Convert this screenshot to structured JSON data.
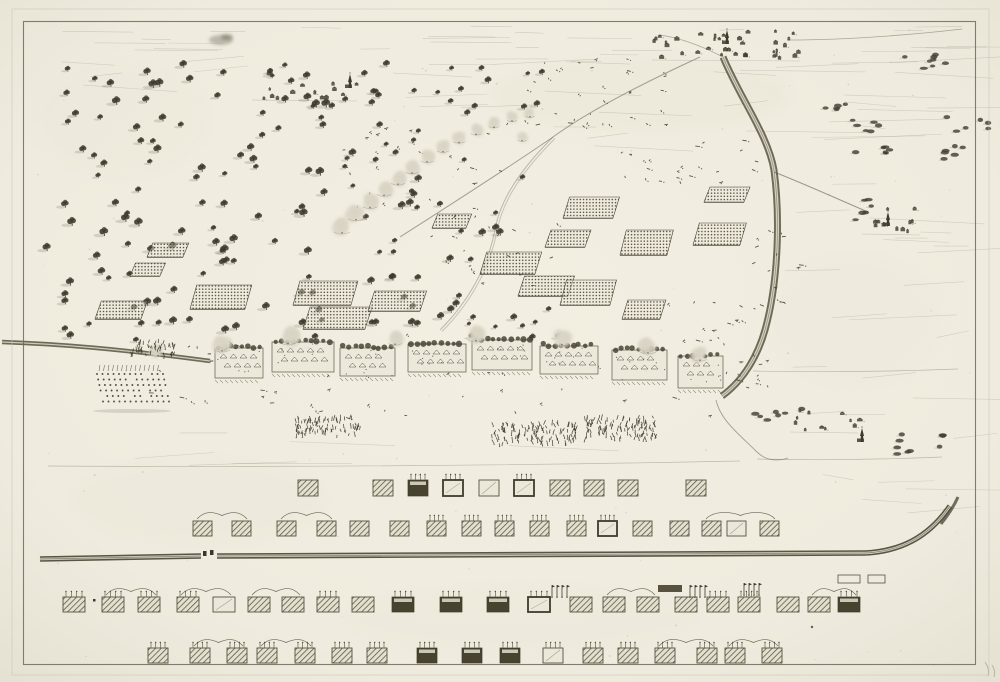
{
  "palette": {
    "paper": "#f0ecdf",
    "paper_edge": "#e6e2d3",
    "ink": "#3f3b2c",
    "ink_mid": "#57533f",
    "ink_light": "#8a8575",
    "smoke": "#d9d4c4",
    "block_light": "#ece8d9",
    "block_dark": "#47432f",
    "road_core": "#d8d4c4",
    "border": "#6d6958",
    "plate_mark": "#c9c4b4",
    "pencil": "#a09a8a"
  },
  "plate": {
    "border": [
      23,
      21,
      952,
      643
    ],
    "plate_mark": [
      12,
      9,
      977,
      666
    ]
  },
  "scene": {
    "speckles": 90,
    "stains": [
      [
        640,
        95,
        150,
        38,
        0.3
      ],
      [
        200,
        500,
        130,
        45,
        0.22
      ],
      [
        520,
        620,
        180,
        35,
        0.16
      ],
      [
        120,
        120,
        90,
        60,
        0.16
      ],
      [
        850,
        320,
        90,
        70,
        0.14
      ]
    ],
    "sky_band": [
      50,
      26,
      910,
      36,
      26
    ],
    "cloud": [
      221,
      40,
      12,
      5
    ],
    "field_line_regions": [
      [
        540,
        62,
        420,
        125,
        22
      ],
      [
        770,
        205,
        195,
        245,
        18
      ],
      [
        380,
        57,
        300,
        65,
        8
      ],
      [
        60,
        432,
        480,
        34,
        6
      ],
      [
        762,
        468,
        190,
        50,
        5
      ],
      [
        40,
        60,
        260,
        40,
        5
      ]
    ],
    "long_lines": [
      [
        48,
        466,
        740,
        461
      ],
      [
        757,
        459,
        942,
        457
      ],
      [
        753,
        371,
        958,
        369
      ]
    ],
    "tree_fields": [
      [
        45,
        58,
        285,
        285,
        105,
        1
      ],
      [
        335,
        150,
        190,
        115,
        26,
        0.9
      ],
      [
        430,
        66,
        130,
        50,
        12,
        0.8
      ],
      [
        250,
        60,
        170,
        45,
        10,
        0.8
      ],
      [
        340,
        270,
        120,
        60,
        14,
        0.9
      ],
      [
        460,
        300,
        120,
        40,
        10,
        0.8
      ],
      [
        300,
        95,
        120,
        55,
        10,
        0.85
      ]
    ],
    "bush_clusters": [
      [
        823,
        103,
        28,
        10,
        5
      ],
      [
        848,
        120,
        34,
        12,
        6
      ],
      [
        852,
        143,
        38,
        12,
        6
      ],
      [
        896,
        50,
        50,
        22,
        8
      ],
      [
        946,
        116,
        44,
        16,
        6
      ],
      [
        941,
        146,
        44,
        14,
        6
      ],
      [
        845,
        196,
        30,
        24,
        6
      ],
      [
        745,
        408,
        60,
        16,
        7
      ],
      [
        862,
        434,
        88,
        20,
        9
      ]
    ],
    "villages": [
      {
        "x": 652,
        "y": 30,
        "w": 148,
        "h": 28,
        "count": 36,
        "church": [
          727,
          44
        ]
      },
      {
        "x": 862,
        "y": 208,
        "w": 58,
        "h": 24,
        "count": 11,
        "church": [
          888,
          226
        ]
      },
      {
        "x": 790,
        "y": 410,
        "w": 68,
        "h": 20,
        "count": 11,
        "church": [
          862,
          442
        ]
      },
      {
        "x": 252,
        "y": 82,
        "w": 105,
        "h": 16,
        "count": 13,
        "church": [
          350,
          88
        ]
      }
    ],
    "roads": [
      {
        "d": "M723,57 C741,100 768,135 774,170 C780,215 779,280 765,330 C758,355 744,380 722,396",
        "w": 7,
        "o": 0.85,
        "core": true
      },
      {
        "d": "M700,57 C650,80 590,110 553,137 C505,170 450,205 400,237",
        "w": 1,
        "o": 0.5
      },
      {
        "d": "M774,172 C800,182 840,200 868,212",
        "w": 1,
        "o": 0.55
      },
      {
        "d": "M790,40 C850,40 920,34 962,29",
        "w": 0.8,
        "o": 0.45
      },
      {
        "d": "M553,137 C520,170 500,200 495,230 C488,265 470,300 440,330",
        "w": 1,
        "o": 0.35,
        "double": true
      },
      {
        "d": "M716,400 C720,420 740,435 757,452 C765,460 775,462 788,458",
        "w": 0.9,
        "o": 0.5
      },
      {
        "d": "M660,35 C680,38 700,45 723,57",
        "w": 0.8,
        "o": 0.45
      }
    ],
    "smoke_line": [
      [
        342,
        228
      ],
      [
        356,
        215
      ],
      [
        370,
        203
      ],
      [
        384,
        191
      ],
      [
        398,
        180
      ],
      [
        412,
        169
      ],
      [
        427,
        158
      ],
      [
        443,
        148
      ],
      [
        459,
        139
      ],
      [
        476,
        131
      ],
      [
        494,
        124
      ],
      [
        512,
        118
      ],
      [
        530,
        114
      ],
      [
        522,
        138
      ]
    ],
    "battalions": [
      [
        190,
        285,
        55,
        24
      ],
      [
        293,
        281,
        58,
        24
      ],
      [
        303,
        307,
        62,
        22
      ],
      [
        368,
        291,
        52,
        20
      ],
      [
        480,
        252,
        55,
        22
      ],
      [
        518,
        276,
        50,
        20
      ],
      [
        545,
        230,
        40,
        17
      ],
      [
        563,
        197,
        50,
        21
      ],
      [
        620,
        230,
        47,
        25
      ],
      [
        693,
        223,
        47,
        22
      ],
      [
        704,
        187,
        40,
        15
      ],
      [
        560,
        280,
        50,
        25
      ],
      [
        622,
        300,
        38,
        19
      ],
      [
        130,
        263,
        30,
        13
      ],
      [
        147,
        243,
        36,
        14
      ],
      [
        95,
        301,
        46,
        18
      ],
      [
        432,
        214,
        34,
        14
      ]
    ],
    "cavalry_fields": [
      [
        520,
        58,
        145,
        75,
        34
      ],
      [
        615,
        138,
        150,
        50,
        22
      ],
      [
        745,
        230,
        60,
        80,
        16
      ],
      [
        340,
        120,
        170,
        90,
        26
      ],
      [
        150,
        330,
        560,
        95,
        55
      ],
      [
        420,
        210,
        140,
        80,
        20
      ],
      [
        660,
        300,
        90,
        50,
        14
      ],
      [
        726,
        352,
        46,
        40,
        12
      ]
    ],
    "pike_block": [
      93,
      372,
      78,
      36
    ],
    "spike_clusters": [
      [
        294,
        418,
        66,
        20
      ],
      [
        492,
        424,
        84,
        22
      ],
      [
        582,
        418,
        74,
        24
      ],
      [
        128,
        342,
        48,
        16
      ]
    ],
    "wall": {
      "d": "M2,342 C60,344 120,349 210,361",
      "w": 4.5
    },
    "redoubts": [
      [
        215,
        344,
        48,
        36
      ],
      [
        272,
        338,
        62,
        36
      ],
      [
        340,
        344,
        55,
        34
      ],
      [
        408,
        340,
        58,
        34
      ],
      [
        472,
        336,
        60,
        36
      ],
      [
        540,
        342,
        58,
        34
      ],
      [
        612,
        346,
        55,
        36
      ],
      [
        678,
        352,
        45,
        38
      ]
    ],
    "line_smokes": [
      [
        222,
        346,
        8
      ],
      [
        288,
        338,
        9
      ],
      [
        476,
        336,
        8
      ],
      [
        562,
        340,
        8
      ],
      [
        648,
        348,
        8
      ],
      [
        700,
        356,
        7
      ],
      [
        158,
        352,
        6
      ],
      [
        395,
        340,
        7
      ]
    ],
    "pencil": "M985,662 q5,7 3,14 M992,665 q4,6 2,12"
  },
  "order_of_battle": {
    "rows": [
      {
        "y": 480,
        "w": 20,
        "h": 16,
        "blocks": [
          [
            298,
            "h",
            0
          ],
          [
            373,
            "h",
            0
          ],
          [
            408,
            "d",
            1
          ],
          [
            443,
            "f",
            1
          ],
          [
            479,
            "l",
            0
          ],
          [
            514,
            "f",
            1
          ],
          [
            550,
            "h",
            0
          ],
          [
            584,
            "h",
            0
          ],
          [
            618,
            "h",
            0
          ],
          [
            686,
            "h",
            0
          ]
        ],
        "braces": []
      },
      {
        "y": 521,
        "w": 19,
        "h": 15,
        "blocks": [
          [
            193,
            "h",
            0
          ],
          [
            232,
            "h",
            0
          ],
          [
            277,
            "h",
            0
          ],
          [
            317,
            "h",
            0
          ],
          [
            350,
            "h",
            0
          ],
          [
            390,
            "h",
            0
          ],
          [
            427,
            "h",
            1
          ],
          [
            462,
            "h",
            1
          ],
          [
            495,
            "h",
            1
          ],
          [
            530,
            "h",
            1
          ],
          [
            567,
            "h",
            1
          ],
          [
            598,
            "f",
            1
          ],
          [
            633,
            "h",
            0
          ],
          [
            670,
            "h",
            0
          ],
          [
            702,
            "h",
            0
          ],
          [
            727,
            "l",
            0
          ],
          [
            760,
            "h",
            0
          ]
        ],
        "braces": [
          [
            193,
            232
          ],
          [
            277,
            317
          ],
          [
            702,
            760
          ]
        ]
      },
      {
        "y": 597,
        "w": 22,
        "h": 15,
        "blocks": [
          [
            63,
            "h",
            1
          ],
          [
            102,
            "h",
            1
          ],
          [
            138,
            "h",
            1
          ],
          [
            177,
            "h",
            1
          ],
          [
            213,
            "l",
            0
          ],
          [
            248,
            "h",
            0
          ],
          [
            282,
            "h",
            0
          ],
          [
            317,
            "h",
            1
          ],
          [
            352,
            "h",
            0
          ],
          [
            392,
            "d",
            1
          ],
          [
            440,
            "d",
            1
          ],
          [
            487,
            "d",
            1
          ],
          [
            528,
            "f",
            1
          ],
          [
            570,
            "h",
            0
          ],
          [
            603,
            "h",
            0
          ],
          [
            637,
            "h",
            0
          ],
          [
            675,
            "h",
            0
          ],
          [
            707,
            "h",
            1
          ],
          [
            738,
            "h",
            1
          ],
          [
            777,
            "h",
            0
          ],
          [
            808,
            "h",
            0
          ],
          [
            838,
            "d",
            1
          ]
        ],
        "braces": [
          [
            102,
            138
          ],
          [
            177,
            213
          ],
          [
            248,
            282
          ],
          [
            603,
            637
          ],
          [
            808,
            838
          ]
        ]
      },
      {
        "y": 648,
        "w": 20,
        "h": 15,
        "blocks": [
          [
            148,
            "h",
            1
          ],
          [
            190,
            "h",
            1
          ],
          [
            227,
            "h",
            1
          ],
          [
            257,
            "h",
            1
          ],
          [
            295,
            "h",
            1
          ],
          [
            332,
            "h",
            1
          ],
          [
            367,
            "h",
            1
          ],
          [
            417,
            "d",
            1
          ],
          [
            462,
            "d",
            1
          ],
          [
            500,
            "d",
            1
          ],
          [
            543,
            "l",
            1
          ],
          [
            583,
            "h",
            1
          ],
          [
            618,
            "h",
            1
          ],
          [
            655,
            "h",
            1
          ],
          [
            697,
            "h",
            1
          ],
          [
            725,
            "h",
            1
          ],
          [
            762,
            "h",
            1
          ]
        ],
        "braces": [
          [
            190,
            227
          ],
          [
            257,
            295
          ],
          [
            655,
            697
          ],
          [
            725,
            762
          ]
        ]
      }
    ],
    "road": {
      "segments": [
        "M40,559 L201,556",
        "M217,556 L866,553",
        "M866,553 C900,551 928,538 950,506"
      ],
      "break": "M941,524 C949,514 954,506 958,497",
      "gap_marks": [
        [
          203,
          551
        ],
        [
          210,
          550
        ]
      ]
    },
    "annotations": {
      "standards": [
        [
          552,
          585
        ],
        [
          690,
          585
        ],
        [
          744,
          583
        ]
      ],
      "bar": [
        658,
        585,
        24,
        7
      ],
      "outline_rects": [
        [
          838,
          575,
          22,
          8
        ],
        [
          868,
          575,
          17,
          8
        ]
      ],
      "dot": [
        93,
        599
      ],
      "mark": [
        812,
        627
      ]
    }
  }
}
